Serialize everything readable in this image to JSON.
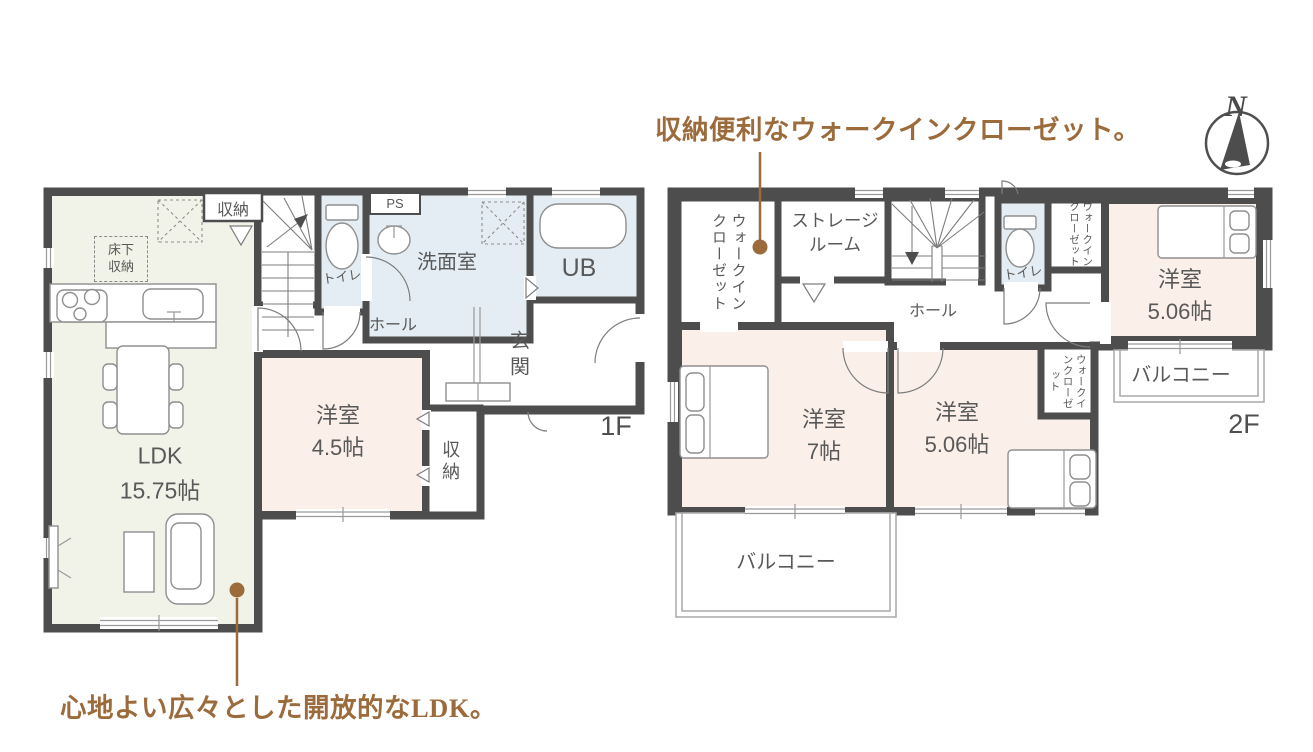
{
  "annotations": {
    "top": "収納便利なウォークインクローゼット。",
    "bottom": "心地よい広々とした開放的なLDK。"
  },
  "compass": {
    "north": "N"
  },
  "floor1": {
    "floor_label": "1F",
    "ldk": {
      "line1": "LDK",
      "line2": "15.75帖"
    },
    "youshitsu_45": {
      "line1": "洋室",
      "line2": "4.5帖"
    },
    "senmenshitsu": "洗面室",
    "unit_bath": "UB",
    "toilet": "トイレ",
    "hall": "ホール",
    "genkan": "玄関",
    "closet_top": "収納",
    "closet_side": "収納",
    "yukashita": {
      "line1": "床下",
      "line2": "収納"
    },
    "pipe_space": "PS"
  },
  "floor2": {
    "floor_label": "2F",
    "wic_left": "ウォークインクローゼット",
    "storage_room": {
      "line1": "ストレージ",
      "line2": "ルーム"
    },
    "toilet": "トイレ",
    "wic_top_right": "ウォークインクローゼット",
    "youshitsu_506_top": {
      "line1": "洋室",
      "line2": "5.06帖"
    },
    "hall": "ホール",
    "youshitsu_7": {
      "line1": "洋室",
      "line2": "7帖"
    },
    "youshitsu_506_bottom": {
      "line1": "洋室",
      "line2": "5.06帖"
    },
    "wic_middle": "ウォークインクローゼット",
    "balcony_right": "バルコニー",
    "balcony_bottom": "バルコニー"
  },
  "colors": {
    "wall": "#4d4d4d",
    "text": "#595959",
    "accent_brown": "#9c6b3c",
    "ldk_floor": "#f1f2e8",
    "bedroom_floor": "#faefe9",
    "wet_area_floor": "#e4edf3"
  }
}
